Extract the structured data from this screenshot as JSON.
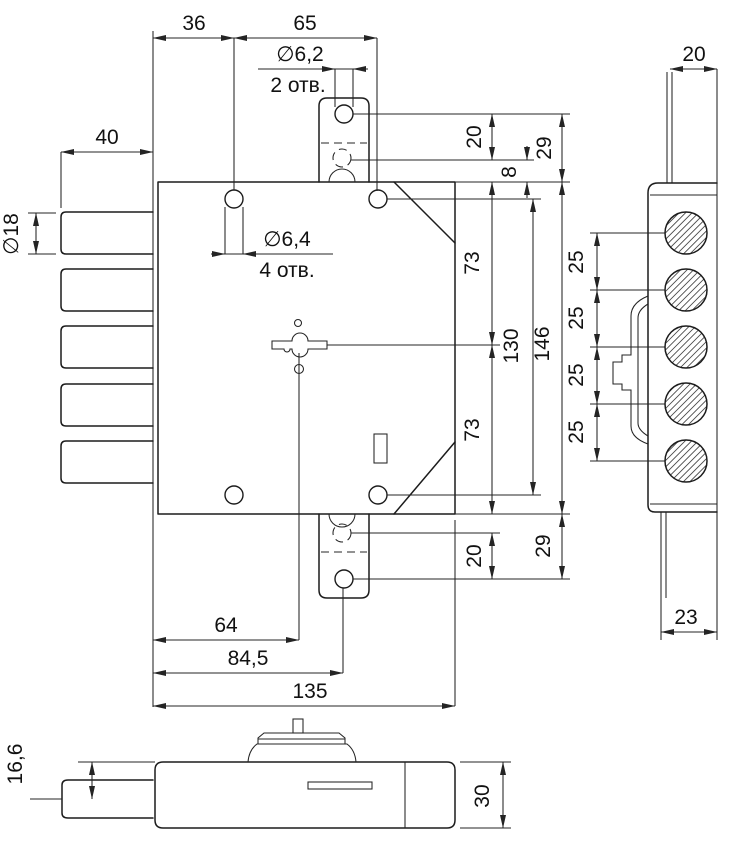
{
  "drawing": {
    "front_view": {
      "top": {
        "dim_36": "36",
        "dim_65": "65"
      },
      "hole_note_top": {
        "diameter": "∅6,2",
        "count": "2 отв."
      },
      "hole_note_main": {
        "diameter": "∅6,4",
        "count": "4 отв."
      },
      "left": {
        "dim_40": "40",
        "dim_dia_18": "∅18"
      },
      "right": {
        "dim_20_top": "20",
        "dim_8": "8",
        "dim_29_top": "29",
        "dim_73_top": "73",
        "dim_130": "130",
        "dim_146": "146",
        "dim_73_bottom": "73",
        "dim_20_bottom": "20",
        "dim_29_bottom": "29"
      },
      "bottom": {
        "dim_64": "64",
        "dim_84_5": "84,5",
        "dim_135": "135"
      }
    },
    "side_view": {
      "dim_20": "20",
      "dim_25": [
        "25",
        "25",
        "25",
        "25"
      ],
      "dim_23": "23"
    },
    "bottom_view": {
      "dim_16_6": "16,6",
      "dim_30": "30"
    },
    "line_color": "#1c1c1c",
    "background": "#ffffff"
  }
}
